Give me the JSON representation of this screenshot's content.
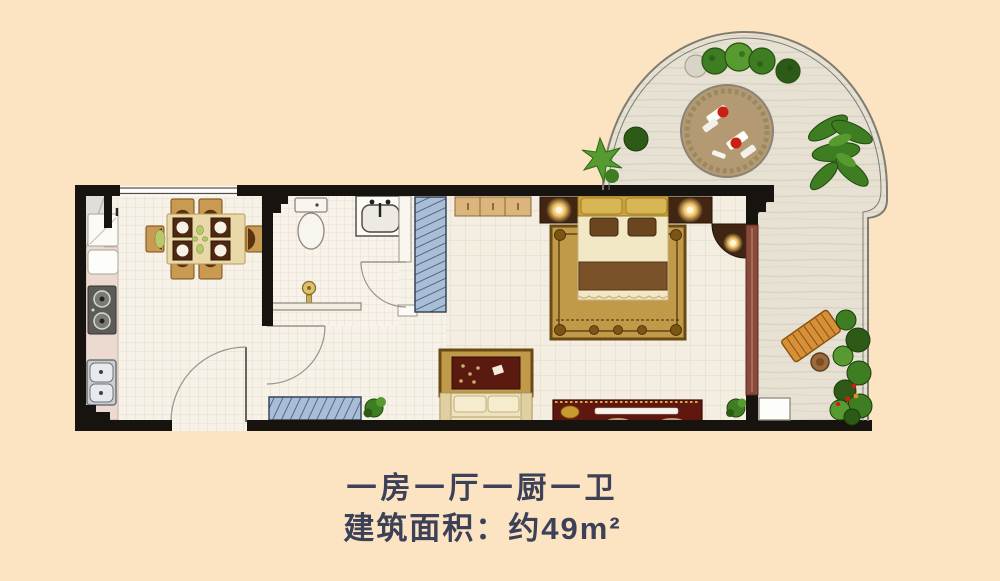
{
  "caption": {
    "line1": "一房一厅一厨一卫",
    "line2": "建筑面积：约49m²"
  },
  "palette": {
    "bg": "#fce4c2",
    "text": "#3c4157",
    "wall": "#17130e",
    "floor": "#f6f2e8",
    "bedroom_floor": "#f3eee1",
    "counter": "#ecd9cf",
    "terrace": "#e6e1d3",
    "railing": "#7d7d73",
    "wood_dark": "#432611",
    "wood_tan": "#c99a52",
    "wardrobe": "#dcb57c",
    "gold": "#c9a23e",
    "pillow_gold": "#d9b654",
    "cream": "#f2e8c6",
    "blanket": "#7a5128",
    "rug_gold": "#c09a48",
    "rug_border": "#6a4a14",
    "rug_red": "#5a1a10",
    "sofa_cream": "#efe3bd",
    "maroon": "#5f1710",
    "blue_panel": "#a9bed6",
    "blue_line": "#51687f",
    "green_dark": "#2d5a16",
    "green": "#3e7d22",
    "green_light": "#569a30",
    "lamp": "#f5c86a",
    "door_brown": "#8a4a3a",
    "bench_orange": "#d89038",
    "patio_floor": "#b49a72",
    "red_accent": "#cc1f14",
    "white": "#fdfdfa"
  }
}
